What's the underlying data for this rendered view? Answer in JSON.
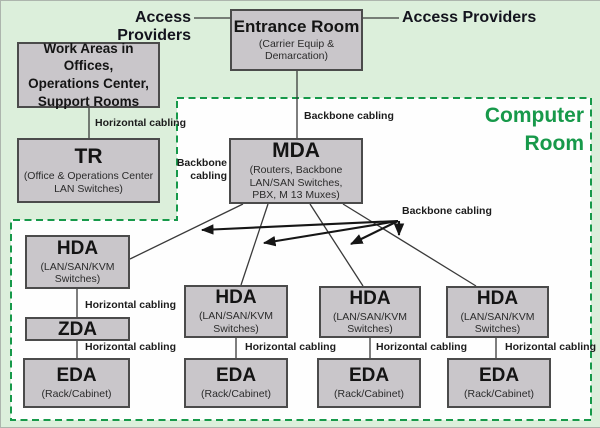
{
  "diagram_title": "Data center structured cabling topology",
  "colors": {
    "page_background": "#dcefdb",
    "computer_room_fill": "#fefefe",
    "computer_room_green": "#17994a",
    "box_fill": "#c9c6ca",
    "box_border": "#4b4b4b",
    "line_color": "#3a3a3a",
    "text_color": "#1c1c1c"
  },
  "labels": {
    "access_providers_left": "Access Providers",
    "access_providers_right": "Access Providers",
    "computer_room": "Computer\nRoom",
    "backbone_cabling_entrance_mda": "Backbone cabling",
    "backbone_cabling_tr_mda": "Backbone\ncabling",
    "backbone_cabling_fanout": "Backbone cabling",
    "horizontal_cabling_work_tr": "Horizontal cabling",
    "horizontal_cabling_hda_zda": "Horizontal cabling",
    "horizontal_cabling_zda_eda": "Horizontal cabling",
    "horizontal_cabling_col2": "Horizontal cabling",
    "horizontal_cabling_col3": "Horizontal cabling",
    "horizontal_cabling_col4": "Horizontal cabling"
  },
  "nodes": {
    "entrance_room": {
      "title": "Entrance Room",
      "subtitle": "(Carrier Equip &\nDemarcation)"
    },
    "work_areas": {
      "title": "Work Areas in Offices,\nOperations Center,\nSupport Rooms"
    },
    "tr": {
      "title": "TR",
      "subtitle": "(Office & Operations Center\nLAN Switches)"
    },
    "mda": {
      "title": "MDA",
      "subtitle": "(Routers, Backbone\nLAN/SAN Switches,\nPBX, M 13 Muxes)"
    },
    "hda_left": {
      "title": "HDA",
      "subtitle": "(LAN/SAN/KVM\nSwitches)"
    },
    "hda_2": {
      "title": "HDA",
      "subtitle": "(LAN/SAN/KVM\nSwitches)"
    },
    "hda_3": {
      "title": "HDA",
      "subtitle": "(LAN/SAN/KVM\nSwitches)"
    },
    "hda_4": {
      "title": "HDA",
      "subtitle": "(LAN/SAN/KVM\nSwitches)"
    },
    "zda": {
      "title": "ZDA"
    },
    "eda_1": {
      "title": "EDA",
      "subtitle": "(Rack/Cabinet)"
    },
    "eda_2": {
      "title": "EDA",
      "subtitle": "(Rack/Cabinet)"
    },
    "eda_3": {
      "title": "EDA",
      "subtitle": "(Rack/Cabinet)"
    },
    "eda_4": {
      "title": "EDA",
      "subtitle": "(Rack/Cabinet)"
    }
  }
}
